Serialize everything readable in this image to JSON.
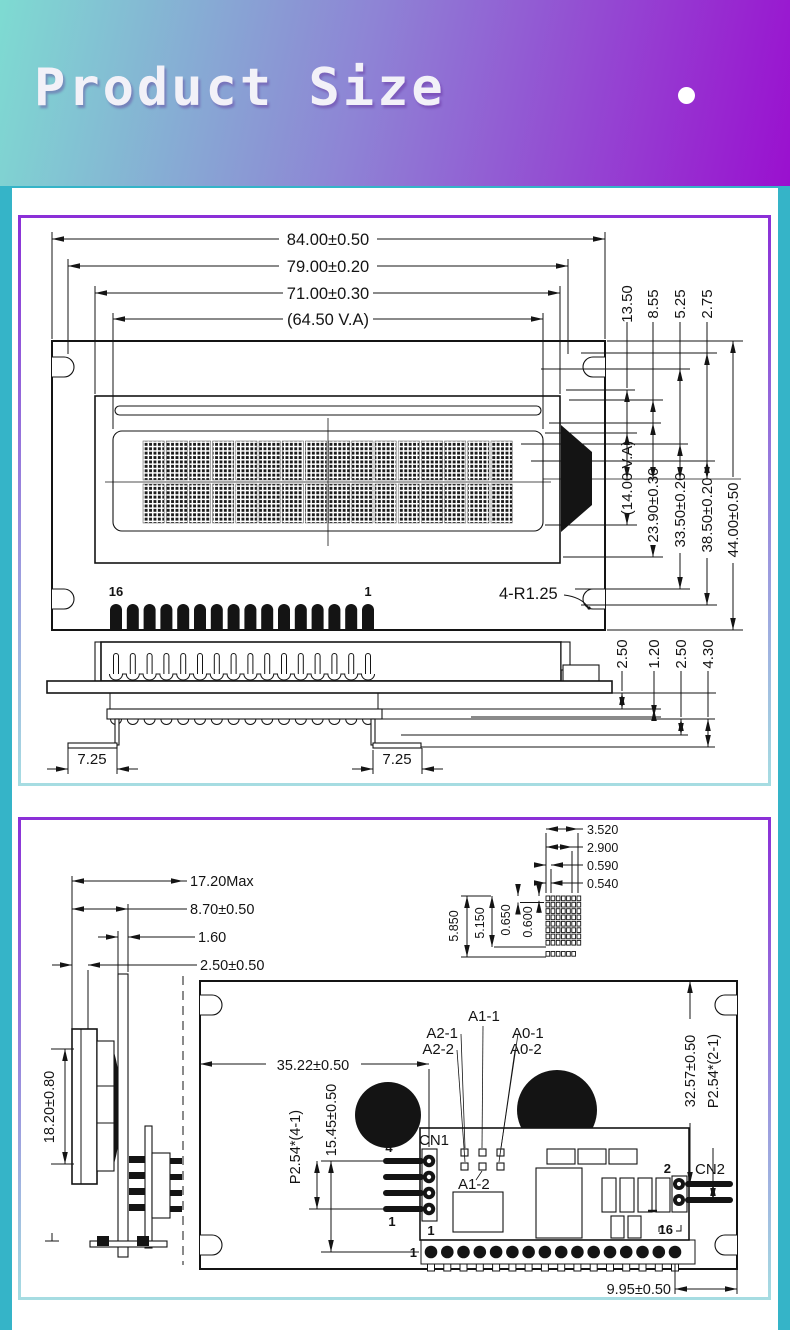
{
  "colors": {
    "page_bg": "#35b4c8",
    "header_gradient_start": "#7edbd2",
    "header_gradient_end": "#9a10cf",
    "panel_border_top": "#8b2fd7",
    "panel_border_bottom": "#a6dde2"
  },
  "header": {
    "title": "Product Size",
    "dot_icon": "circle"
  },
  "panel1": {
    "top_dims": [
      "84.00±0.50",
      "79.00±0.20",
      "71.00±0.30",
      "(64.50 V.A)"
    ],
    "right_small_dims": [
      "13.50",
      "8.55",
      "5.25",
      "2.75"
    ],
    "right_large_dims": [
      "(14.00 V.A)",
      "23.90±0.30",
      "33.50±0.20",
      "38.50±0.20",
      "44.00±0.50"
    ],
    "pin_label_left": "16",
    "pin_label_right": "1",
    "corner_radius_note": "4-R1.25",
    "side_view": {
      "foot_dim_left": "7.25",
      "foot_dim_right": "7.25",
      "stack_dims": [
        "2.50",
        "1.20",
        "2.50",
        "4.30"
      ]
    }
  },
  "panel2": {
    "depth_dims": [
      "17.20Max",
      "8.70±0.50",
      "1.60",
      "2.50±0.50"
    ],
    "height_dim": "18.20±0.80",
    "cell_detail": {
      "h_dims": [
        "3.520",
        "2.900",
        "0.590",
        "0.540"
      ],
      "v_dims": [
        "5.850",
        "5.150",
        "0.650",
        "0.600"
      ]
    },
    "back_view": {
      "width_dim": "35.22±0.50",
      "jumpers": [
        "A2-1",
        "A2-2",
        "A1-1",
        "A1-2",
        "A0-1",
        "A0-2"
      ],
      "cn1": {
        "label": "CN1",
        "pin_top": "4",
        "pin_bottom": "1",
        "pitch_dim": "P2.54*(4-1)",
        "offset_dim": "15.45±0.50"
      },
      "cn2": {
        "label": "CN2",
        "pin_top": "2",
        "pitch_dim": "P2.54*(2-1)",
        "height_dim": "32.57±0.50"
      },
      "pin_row": {
        "row_label": "1",
        "first": "1",
        "last": "16",
        "edge_dim": "9.95±0.50"
      }
    }
  }
}
